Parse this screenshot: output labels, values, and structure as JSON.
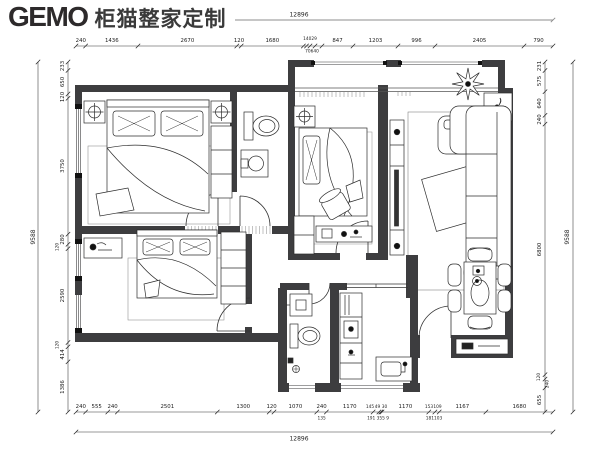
{
  "brand": {
    "logo": "GEMO",
    "name": "柜猫整家定制"
  },
  "dims": {
    "top_total": "12896",
    "bottom_total": "12896",
    "left_total": "9588",
    "right_total": "9588",
    "top": [
      "240",
      "1436",
      "2670",
      "120",
      "1680",
      "847",
      "1203",
      "996",
      "2405",
      "790"
    ],
    "top_cluster_main": "14029",
    "top_cluster_sub": "70640",
    "left": [
      "233",
      "650",
      "120",
      "3750",
      "280",
      "120",
      "2590",
      "120",
      "414",
      "1386"
    ],
    "right": [
      "231",
      "575",
      "640",
      "240",
      "6800",
      "120",
      "240",
      "655"
    ],
    "bottom": [
      "240",
      "555",
      "240",
      "2501",
      "1300",
      "120",
      "1070",
      "240",
      "1170",
      "145",
      "49",
      "30",
      "1170",
      "153",
      "109",
      "1167",
      "1680"
    ],
    "bottom_sub": [
      "135",
      "191 355 9",
      "181103"
    ]
  }
}
